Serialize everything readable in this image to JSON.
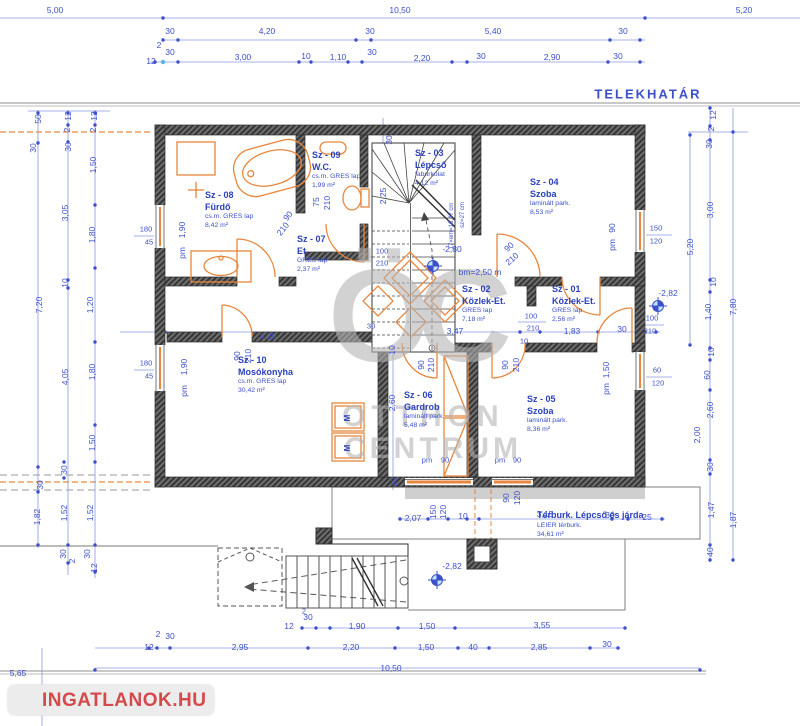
{
  "boundary_label": "TELEKHATÁR",
  "watermark": {
    "monogram": "ÖC",
    "line1": "OTTHON",
    "line2": "CENTRUM"
  },
  "brand": {
    "name": "INGATLANOK.HU"
  },
  "colors": {
    "dim_blue": "#3c50cc",
    "fixture_orange": "#e8863c",
    "wall_gray": "#5a5a5a",
    "watermark_gray": "#b3b3b3",
    "brand_red": "#d4494b"
  },
  "rooms": [
    {
      "id": "Sz - 08",
      "name": "Fürdő",
      "finish": "cs.m. GRES lap",
      "area": "8,42 m²",
      "x": 205,
      "y": 190
    },
    {
      "id": "Sz - 09",
      "name": "W.C.",
      "finish": "cs.m. GRES lap",
      "area": "1,99 m²",
      "x": 312,
      "y": 150
    },
    {
      "id": "Sz - 03",
      "name": "Lépcső",
      "finish": "faburkolat",
      "area": "4,12 m²",
      "x": 415,
      "y": 148
    },
    {
      "id": "Sz - 04",
      "name": "Szoba",
      "finish": "laminált park.",
      "area": "8,53 m²",
      "x": 530,
      "y": 177
    },
    {
      "id": "Sz - 07",
      "name": "Et.",
      "finish": "GRES lap",
      "area": "2,37 m²",
      "x": 297,
      "y": 234
    },
    {
      "id": "Sz - 02",
      "name": "Közlek-Et.",
      "finish": "GRES lap",
      "area": "7,18 m²",
      "x": 462,
      "y": 284
    },
    {
      "id": "Sz - 01",
      "name": "Közlek-Et.",
      "finish": "GRES lap",
      "area": "2,56 m²",
      "x": 552,
      "y": 284
    },
    {
      "id": "Sz - 10",
      "name": "Mosókonyha",
      "finish": "cs.m. GRES lap",
      "area": "30,42 m²",
      "x": 238,
      "y": 355
    },
    {
      "id": "Sz - 06",
      "name": "Gardrob",
      "finish": "laminált park.",
      "area": "5,48 m²",
      "x": 404,
      "y": 390
    },
    {
      "id": "Sz - 05",
      "name": "Szoba",
      "finish": "laminált park.",
      "area": "8,36 m²",
      "x": 527,
      "y": 394
    },
    {
      "id": "",
      "name": "Térburk. Lépcső és járda",
      "finish": "LEIER térburk.",
      "area": "34,61 m²",
      "x": 537,
      "y": 510
    }
  ],
  "labels": [
    {
      "t": "5,00",
      "x": 55,
      "y": 10
    },
    {
      "t": "10,50",
      "x": 400,
      "y": 10
    },
    {
      "t": "5,20",
      "x": 744,
      "y": 10
    },
    {
      "t": "30",
      "x": 170,
      "y": 31
    },
    {
      "t": "4,20",
      "x": 267,
      "y": 31
    },
    {
      "t": "30",
      "x": 370,
      "y": 31
    },
    {
      "t": "5,40",
      "x": 493,
      "y": 31
    },
    {
      "t": "30",
      "x": 623,
      "y": 31
    },
    {
      "t": "2",
      "x": 159,
      "y": 45
    },
    {
      "t": "30",
      "x": 170,
      "y": 52
    },
    {
      "t": "12",
      "x": 151,
      "y": 61
    },
    {
      "t": "3,00",
      "x": 243,
      "y": 57
    },
    {
      "t": "10",
      "x": 306,
      "y": 56
    },
    {
      "t": "1,10",
      "x": 338,
      "y": 57
    },
    {
      "t": "30",
      "x": 372,
      "y": 52
    },
    {
      "t": "2,20",
      "x": 422,
      "y": 58
    },
    {
      "t": "30",
      "x": 481,
      "y": 56
    },
    {
      "t": "2,90",
      "x": 552,
      "y": 57
    },
    {
      "t": "30",
      "x": 618,
      "y": 56
    },
    {
      "t": "50",
      "x": 38,
      "y": 119,
      "r": -90
    },
    {
      "t": "30",
      "x": 33,
      "y": 148,
      "r": -90
    },
    {
      "t": "7,20",
      "x": 39,
      "y": 305,
      "r": -90
    },
    {
      "t": "12",
      "x": 68,
      "y": 116,
      "r": -90
    },
    {
      "t": "2",
      "x": 67,
      "y": 130,
      "r": -90
    },
    {
      "t": "30",
      "x": 68,
      "y": 147,
      "r": -90
    },
    {
      "t": "3,05",
      "x": 65,
      "y": 213,
      "r": -90
    },
    {
      "t": "10",
      "x": 65,
      "y": 283,
      "r": -90
    },
    {
      "t": "12",
      "x": 94,
      "y": 116,
      "r": -90
    },
    {
      "t": "2",
      "x": 93,
      "y": 130,
      "r": -90
    },
    {
      "t": "1,50",
      "x": 93,
      "y": 165,
      "r": -90
    },
    {
      "t": "1,80",
      "x": 92,
      "y": 235,
      "r": -90
    },
    {
      "t": "1,20",
      "x": 90,
      "y": 305,
      "r": -90
    },
    {
      "t": "4,05",
      "x": 65,
      "y": 377,
      "r": -90
    },
    {
      "t": "1,80",
      "x": 92,
      "y": 372,
      "r": -90
    },
    {
      "t": "1,50",
      "x": 92,
      "y": 443,
      "r": -90
    },
    {
      "t": "30",
      "x": 64,
      "y": 470,
      "r": -90
    },
    {
      "t": "30",
      "x": 40,
      "y": 485,
      "r": -90
    },
    {
      "t": "1,82",
      "x": 37,
      "y": 517,
      "r": -90
    },
    {
      "t": "1,52",
      "x": 64,
      "y": 513,
      "r": -90
    },
    {
      "t": "1,52",
      "x": 90,
      "y": 513,
      "r": -90
    },
    {
      "t": "30",
      "x": 63,
      "y": 554,
      "r": -90
    },
    {
      "t": "2",
      "x": 72,
      "y": 561,
      "r": -90
    },
    {
      "t": "30",
      "x": 87,
      "y": 554,
      "r": -90
    },
    {
      "t": "12",
      "x": 94,
      "y": 568,
      "r": -90
    },
    {
      "t": "8,10",
      "x": 27,
      "y": 694,
      "r": -90
    },
    {
      "t": "5,65",
      "x": 18,
      "y": 673
    },
    {
      "t": "180",
      "x": 146,
      "y": 229,
      "k": "small"
    },
    {
      "t": "45",
      "x": 149,
      "y": 242,
      "k": "small"
    },
    {
      "t": "1,90",
      "x": 182,
      "y": 230,
      "r": -90
    },
    {
      "t": "pm",
      "x": 182,
      "y": 253,
      "r": -90
    },
    {
      "t": "180",
      "x": 146,
      "y": 363,
      "k": "small"
    },
    {
      "t": "45",
      "x": 149,
      "y": 376,
      "k": "small"
    },
    {
      "t": "1,90",
      "x": 184,
      "y": 367,
      "r": -90
    },
    {
      "t": "pm",
      "x": 184,
      "y": 391,
      "r": -90
    },
    {
      "t": "12",
      "x": 713,
      "y": 115,
      "r": -90
    },
    {
      "t": "2",
      "x": 711,
      "y": 129,
      "r": -90
    },
    {
      "t": "30",
      "x": 709,
      "y": 144,
      "r": -90
    },
    {
      "t": "3,00",
      "x": 710,
      "y": 210,
      "r": -90
    },
    {
      "t": "5,20",
      "x": 690,
      "y": 247,
      "r": -90
    },
    {
      "t": "10",
      "x": 713,
      "y": 282,
      "r": -90
    },
    {
      "t": "1,40",
      "x": 708,
      "y": 312,
      "r": -90
    },
    {
      "t": "7,80",
      "x": 733,
      "y": 307,
      "r": -90
    },
    {
      "t": "10",
      "x": 711,
      "y": 352,
      "r": -90
    },
    {
      "t": "60",
      "x": 707,
      "y": 375,
      "r": -90
    },
    {
      "t": "2,60",
      "x": 710,
      "y": 410,
      "r": -90
    },
    {
      "t": "2,00",
      "x": 697,
      "y": 435,
      "r": -90
    },
    {
      "t": "30",
      "x": 710,
      "y": 467,
      "r": -90
    },
    {
      "t": "1,47",
      "x": 711,
      "y": 510,
      "r": -90
    },
    {
      "t": "1,87",
      "x": 733,
      "y": 520,
      "r": -90
    },
    {
      "t": "40",
      "x": 710,
      "y": 552,
      "r": -90
    },
    {
      "t": "90",
      "x": 612,
      "y": 228,
      "r": -90
    },
    {
      "t": "pm",
      "x": 612,
      "y": 245,
      "r": -90
    },
    {
      "t": "150",
      "x": 656,
      "y": 228,
      "k": "small"
    },
    {
      "t": "120",
      "x": 656,
      "y": 241,
      "k": "small"
    },
    {
      "t": "-2,82",
      "x": 668,
      "y": 293
    },
    {
      "t": "100",
      "x": 652,
      "y": 318,
      "k": "small"
    },
    {
      "t": "210",
      "x": 650,
      "y": 331,
      "k": "small"
    },
    {
      "t": "1,50",
      "x": 606,
      "y": 370,
      "r": -90
    },
    {
      "t": "pm",
      "x": 606,
      "y": 389,
      "r": -90
    },
    {
      "t": "60",
      "x": 657,
      "y": 370,
      "k": "small"
    },
    {
      "t": "120",
      "x": 658,
      "y": 383,
      "k": "small"
    },
    {
      "t": "30",
      "x": 389,
      "y": 140,
      "r": -90
    },
    {
      "t": "2,25",
      "x": 383,
      "y": 196,
      "r": -90
    },
    {
      "t": "75",
      "x": 316,
      "y": 202,
      "r": -90
    },
    {
      "t": "210",
      "x": 327,
      "y": 203,
      "r": -90
    },
    {
      "t": "90",
      "x": 288,
      "y": 216,
      "r": -52
    },
    {
      "t": "210",
      "x": 283,
      "y": 229,
      "r": -52
    },
    {
      "t": "100",
      "x": 382,
      "y": 251,
      "k": "small"
    },
    {
      "t": "210",
      "x": 382,
      "y": 263,
      "k": "small"
    },
    {
      "t": "-2,80",
      "x": 452,
      "y": 249
    },
    {
      "t": "bm=2,50 m",
      "x": 480,
      "y": 272
    },
    {
      "t": "90",
      "x": 509,
      "y": 247,
      "r": -42
    },
    {
      "t": "210",
      "x": 512,
      "y": 259,
      "r": -42
    },
    {
      "t": "17×em=16,47 cm",
      "x": 452,
      "y": 226,
      "r": -90,
      "k": "note"
    },
    {
      "t": "sz=27 cm",
      "x": 463,
      "y": 215,
      "r": -90,
      "k": "note"
    },
    {
      "t": "4,20",
      "x": 268,
      "y": 336
    },
    {
      "t": "3,47",
      "x": 455,
      "y": 331
    },
    {
      "t": "100",
      "x": 531,
      "y": 316,
      "k": "small"
    },
    {
      "t": "210",
      "x": 533,
      "y": 328,
      "k": "small"
    },
    {
      "t": "10",
      "x": 524,
      "y": 341,
      "k": "small"
    },
    {
      "t": "1,83",
      "x": 572,
      "y": 331
    },
    {
      "t": "30",
      "x": 622,
      "y": 329
    },
    {
      "t": "30",
      "x": 371,
      "y": 326,
      "k": "small"
    },
    {
      "t": "10",
      "x": 392,
      "y": 350,
      "r": -90
    },
    {
      "t": "2,60",
      "x": 392,
      "y": 403,
      "r": -90
    },
    {
      "t": "30",
      "x": 394,
      "y": 482,
      "r": -90
    },
    {
      "t": "90",
      "x": 421,
      "y": 365,
      "r": -90
    },
    {
      "t": "210",
      "x": 431,
      "y": 365,
      "r": -90
    },
    {
      "t": "90",
      "x": 505,
      "y": 365,
      "r": -90
    },
    {
      "t": "210",
      "x": 516,
      "y": 365,
      "r": -90
    },
    {
      "t": "90",
      "x": 237,
      "y": 356,
      "r": -90
    },
    {
      "t": "210",
      "x": 248,
      "y": 356,
      "r": -90
    },
    {
      "t": "pm",
      "x": 427,
      "y": 460,
      "k": "small"
    },
    {
      "t": "90",
      "x": 445,
      "y": 460,
      "k": "small"
    },
    {
      "t": "pm",
      "x": 500,
      "y": 460,
      "k": "small"
    },
    {
      "t": "90",
      "x": 517,
      "y": 460,
      "k": "small"
    },
    {
      "t": "90",
      "x": 506,
      "y": 498,
      "r": -90
    },
    {
      "t": "120",
      "x": 517,
      "y": 498,
      "r": -90
    },
    {
      "t": "-2,82",
      "x": 452,
      "y": 566
    },
    {
      "t": "2,07",
      "x": 413,
      "y": 518
    },
    {
      "t": "150",
      "x": 433,
      "y": 512,
      "r": -90
    },
    {
      "t": "120",
      "x": 443,
      "y": 512,
      "r": -90
    },
    {
      "t": "10",
      "x": 463,
      "y": 516
    },
    {
      "t": "3,15",
      "x": 545,
      "y": 514
    },
    {
      "t": "30",
      "x": 610,
      "y": 515
    },
    {
      "t": "25",
      "x": 647,
      "y": 517
    },
    {
      "t": "M",
      "x": 348,
      "y": 418,
      "r": -90,
      "k": "m"
    },
    {
      "t": "M",
      "x": 348,
      "y": 448,
      "r": -90,
      "k": "m"
    },
    {
      "t": "30",
      "x": 308,
      "y": 617
    },
    {
      "t": "12",
      "x": 289,
      "y": 626
    },
    {
      "t": "1,90",
      "x": 357,
      "y": 626
    },
    {
      "t": "1,50",
      "x": 427,
      "y": 626
    },
    {
      "t": "3,55",
      "x": 542,
      "y": 625
    },
    {
      "t": "2",
      "x": 158,
      "y": 634
    },
    {
      "t": "30",
      "x": 170,
      "y": 636
    },
    {
      "t": "12",
      "x": 149,
      "y": 647
    },
    {
      "t": "2,95",
      "x": 240,
      "y": 647
    },
    {
      "t": "2,20",
      "x": 351,
      "y": 647
    },
    {
      "t": "1,50",
      "x": 426,
      "y": 647
    },
    {
      "t": "40",
      "x": 473,
      "y": 647
    },
    {
      "t": "2,85",
      "x": 539,
      "y": 647
    },
    {
      "t": "30",
      "x": 607,
      "y": 644
    },
    {
      "t": "10,50",
      "x": 391,
      "y": 668
    },
    {
      "t": "2",
      "x": 304,
      "y": 611,
      "k": "small"
    }
  ]
}
